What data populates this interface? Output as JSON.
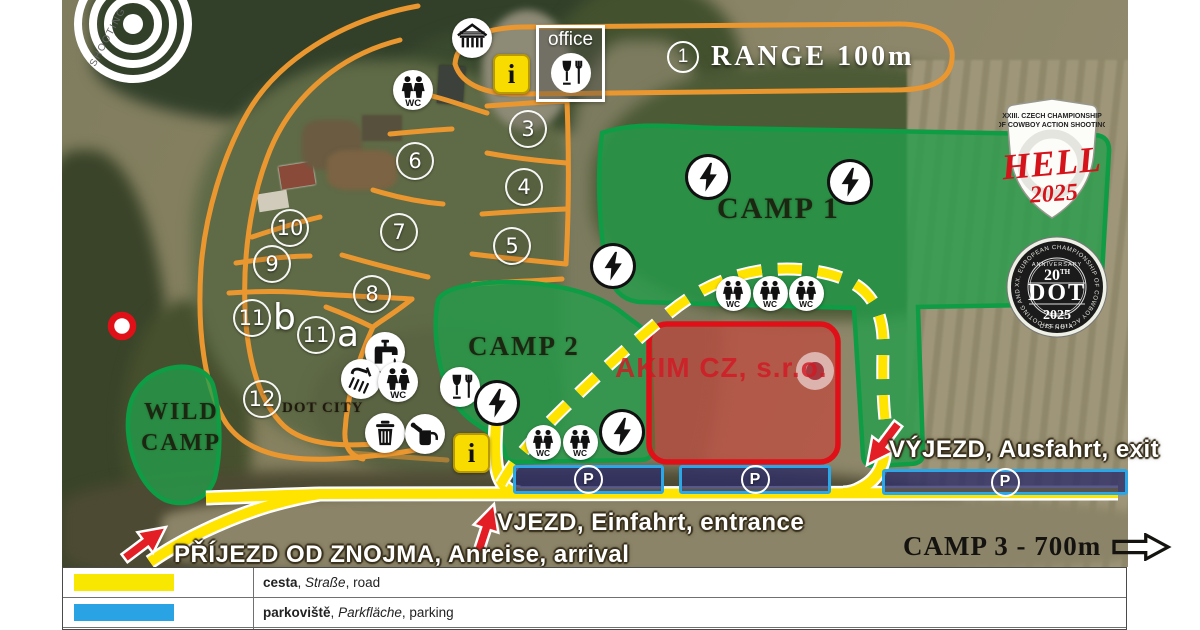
{
  "map": {
    "logo_text": "SHOOTING",
    "range": {
      "number": "1",
      "label": "RANGE 100m"
    },
    "areas": {
      "camp1": "CAMP 1",
      "camp2": "CAMP 2",
      "wild_line1": "WILD",
      "wild_line2": "CAMP",
      "dot_city": "DOT CITY",
      "akim": "AKIM CZ, s.r.o."
    },
    "office_label": "office",
    "camp3_label": "CAMP 3 - 700m",
    "directions": {
      "exit": "VÝJEZD, Ausfahrt, exit",
      "entrance": "VJEZD, Einfahrt, entrance",
      "arrival": "PŘÍJEZD OD ZNOJMA, Anreise, arrival"
    },
    "stations": [
      {
        "n": "3",
        "x": 526,
        "y": 127
      },
      {
        "n": "4",
        "x": 522,
        "y": 185
      },
      {
        "n": "5",
        "x": 510,
        "y": 244
      },
      {
        "n": "6",
        "x": 413,
        "y": 159
      },
      {
        "n": "7",
        "x": 397,
        "y": 230
      },
      {
        "n": "8",
        "x": 370,
        "y": 292
      },
      {
        "n": "9",
        "x": 270,
        "y": 262
      },
      {
        "n": "10",
        "x": 288,
        "y": 226
      },
      {
        "n": "11",
        "suffix": "b",
        "x": 250,
        "y": 316
      },
      {
        "n": "11",
        "suffix": "a",
        "x": 314,
        "y": 333
      },
      {
        "n": "12",
        "x": 260,
        "y": 397
      }
    ],
    "icons": [
      {
        "name": "wc-icon",
        "type": "wc",
        "x": 413,
        "y": 90
      },
      {
        "name": "shelter-icon",
        "type": "shelter",
        "x": 472,
        "y": 38
      },
      {
        "name": "tap-icon",
        "type": "tap",
        "x": 385,
        "y": 352
      },
      {
        "name": "shower-icon",
        "type": "shower",
        "x": 361,
        "y": 379
      },
      {
        "name": "wc-icon",
        "type": "wc",
        "x": 398,
        "y": 382
      },
      {
        "name": "trash-icon",
        "type": "trash",
        "x": 385,
        "y": 433
      },
      {
        "name": "watering-can-icon",
        "type": "can",
        "x": 425,
        "y": 434
      },
      {
        "name": "food-icon",
        "type": "food",
        "x": 460,
        "y": 387
      },
      {
        "name": "power-icon",
        "type": "power",
        "x": 708,
        "y": 177
      },
      {
        "name": "power-icon",
        "type": "power",
        "x": 850,
        "y": 182
      },
      {
        "name": "power-icon",
        "type": "power",
        "x": 613,
        "y": 266
      },
      {
        "name": "power-icon",
        "type": "power",
        "x": 497,
        "y": 403
      },
      {
        "name": "power-icon",
        "type": "power",
        "x": 622,
        "y": 432
      },
      {
        "name": "wc-icon",
        "type": "wc",
        "x": 733,
        "y": 293,
        "small": true
      },
      {
        "name": "wc-icon",
        "type": "wc",
        "x": 770,
        "y": 293,
        "small": true
      },
      {
        "name": "wc-icon",
        "type": "wc",
        "x": 806,
        "y": 293,
        "small": true
      },
      {
        "name": "wc-icon",
        "type": "wc",
        "x": 543,
        "y": 442,
        "small": true
      },
      {
        "name": "wc-icon",
        "type": "wc",
        "x": 580,
        "y": 442,
        "small": true
      }
    ],
    "info_points": [
      {
        "x": 510,
        "y": 72
      },
      {
        "x": 470,
        "y": 451
      }
    ],
    "parking": {
      "symbol": "P",
      "strips": [
        {
          "x": 513,
          "y": 465,
          "w": 145,
          "h": 23
        },
        {
          "x": 679,
          "y": 465,
          "w": 146,
          "h": 23
        },
        {
          "x": 882,
          "y": 469,
          "w": 240,
          "h": 20
        }
      ]
    }
  },
  "badges": {
    "hell": {
      "top1": "XXIII. CZECH CHAMPIONSHIP",
      "top2": "OF COWBOY ACTION SHOOTING",
      "title": "HELL",
      "year": "2025"
    },
    "dot": {
      "ring": "XX. EUROPEAN CHAMPIONSHIP OF COWBOY ACTION SHOOTING AND WILD BUNCH •",
      "anniversary": "ANNIVERSARY",
      "num": "20",
      "sup": "TH",
      "title": "DOT",
      "year": "2025",
      "country": "CZECHIA"
    }
  },
  "legend": {
    "rows": [
      {
        "color": "#F8E700",
        "term": "cesta",
        "de": "Straße",
        "en": "road"
      },
      {
        "color": "#29A3E4",
        "term": "parkoviště",
        "de": "Parkfläche",
        "en": "parking"
      }
    ]
  },
  "colors": {
    "road_yellow": "#FFE400",
    "parking_blue": "#2AA7E8",
    "camp_green": "#0E9C45",
    "restricted_red": "#E01018",
    "trail_orange": "#EB9730"
  }
}
